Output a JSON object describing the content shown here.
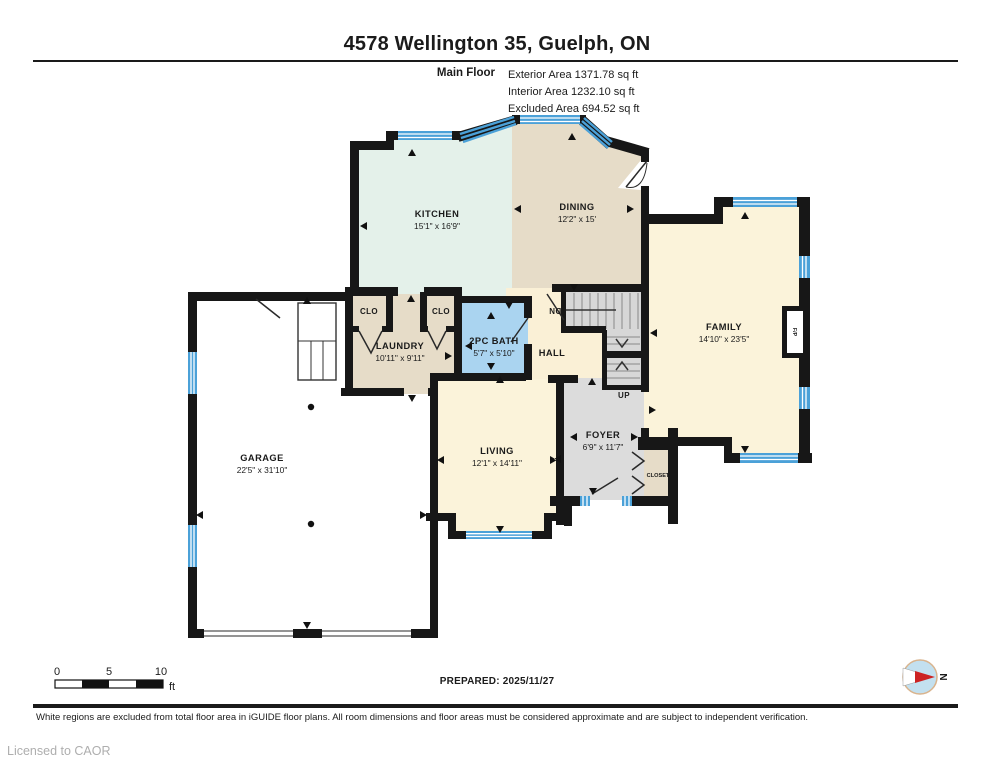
{
  "header": {
    "title": "4578 Wellington 35, Guelph, ON",
    "floor_label": "Main Floor",
    "area_lines": [
      "Exterior Area 1371.78 sq ft",
      "Interior Area 1232.10 sq ft",
      "Excluded Area 694.52 sq ft"
    ]
  },
  "rooms": {
    "kitchen": {
      "name": "KITCHEN",
      "dims": "15'1\" x 16'9\""
    },
    "dining": {
      "name": "DINING",
      "dims": "12'2\" x 15'"
    },
    "family": {
      "name": "FAMILY",
      "dims": "14'10\" x 23'5\""
    },
    "laundry": {
      "name": "LAUNDRY",
      "dims": "10'11\" x 9'11\""
    },
    "bath": {
      "name": "2PC BATH",
      "dims": "5'7\" x 5'10\""
    },
    "hall": {
      "name": "HALL"
    },
    "living": {
      "name": "LIVING",
      "dims": "12'1\" x 14'11\""
    },
    "foyer": {
      "name": "FOYER",
      "dims": "6'9\" x 11'7\""
    },
    "garage": {
      "name": "GARAGE",
      "dims": "22'5\" x 31'10\""
    },
    "clo_left": {
      "name": "CLO"
    },
    "clo_right": {
      "name": "CLO"
    },
    "closet": {
      "name": "CLOSET"
    },
    "stair_up": {
      "name": "UP"
    },
    "stair_dn": {
      "name": "DN"
    },
    "fireplace": {
      "name": "F/P"
    }
  },
  "footer": {
    "scale": {
      "tick0": "0",
      "tick5": "5",
      "tick10": "10",
      "unit": "ft"
    },
    "prepared": "PREPARED: 2025/11/27",
    "compass": "N",
    "disclaimer": "White regions are excluded from total floor area in iGUIDE floor plans. All room dimensions and floor areas must be considered approximate and are subject to independent verification.",
    "license": "Licensed to CAOR"
  },
  "colors": {
    "wall": "#171717",
    "window_blue": "#4ba1d8",
    "kitchen_mint": "#e4f1ea",
    "tan": "#e6dcc8",
    "cream": "#fbf3da",
    "bath_blue": "#aad4f0",
    "foyer_grey": "#dcdcdc",
    "stair_grey": "#d7d7d7",
    "compass_red": "#cc2222"
  }
}
